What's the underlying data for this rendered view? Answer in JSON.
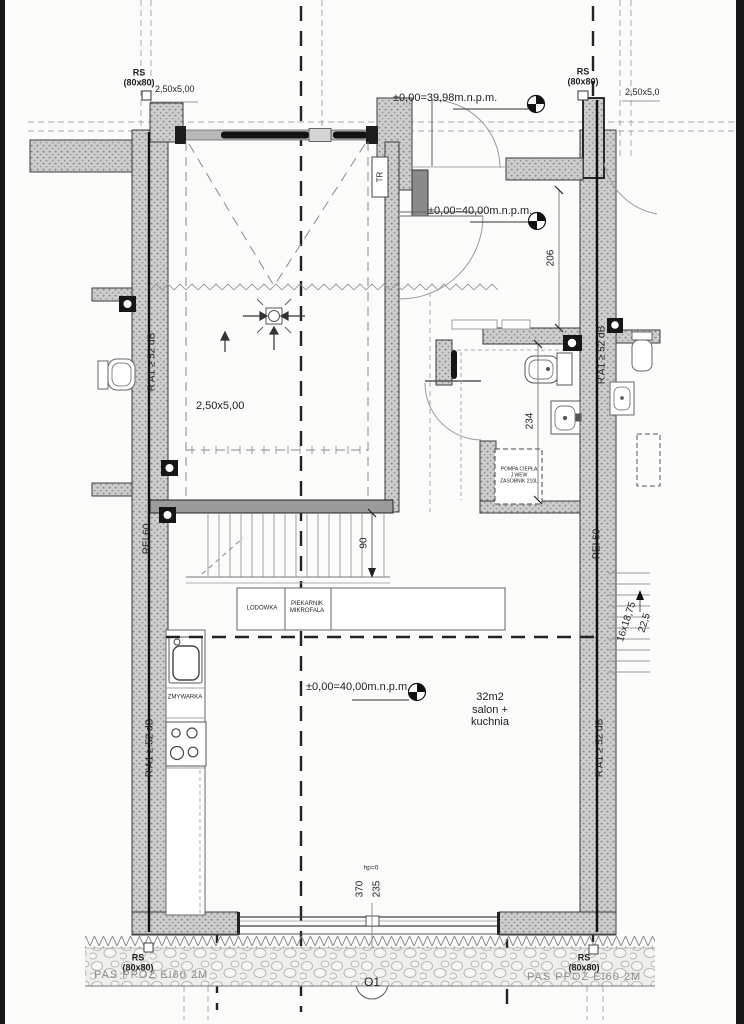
{
  "labels": {
    "rs": "RS",
    "rs_size": "(80x80)",
    "module_dim": "2,50x5,00",
    "elev_entry": "±0,00=39,98m.n.p.m.",
    "elev_main": "±0,00=40,00m.n.p.m.",
    "garage_dim": "2,50x5,00",
    "tr": "TR",
    "acoustic": "R'A1 ≥ 52 dB",
    "fire_wall": "REI 60",
    "fridge": "LODÓWKA",
    "oven_line1": "PIEKARNIK",
    "oven_line2": "MIKROFALA",
    "dishwasher": "ZMYWARKA",
    "heatpump_line1": "POMPA CIEPŁA",
    "heatpump_line2": "J.WEW",
    "heatpump_line3": "ZASOBNIK 210L",
    "area": "32m2",
    "room_line1": "salon +",
    "room_line2": "kuchnia",
    "hp": "hp=0",
    "window_tag": "O1",
    "fire_strip": "PAS PPOŻ EI60 2M"
  },
  "dimensions": {
    "hall": "206",
    "bath": "234",
    "stair_width": "90",
    "win_a": "370",
    "win_b": "235",
    "stairs": "16x18,75",
    "tread": "22,5"
  },
  "colors": {
    "wall_hatch": "#cdcdcd",
    "line_dark": "#1c1c1c",
    "line_gray": "#999999",
    "stone_band": "#efeeec"
  }
}
